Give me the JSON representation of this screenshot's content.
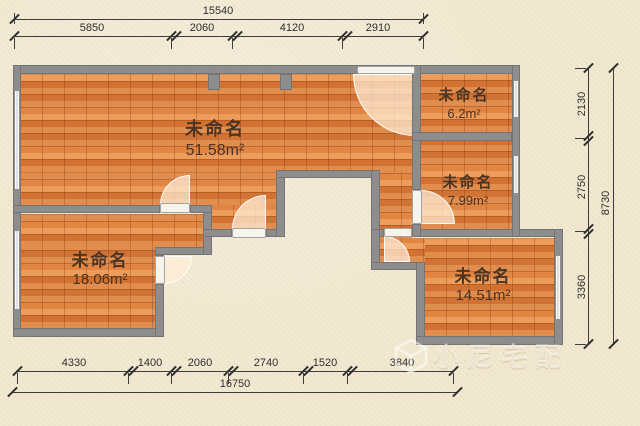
{
  "plan": {
    "rooms": [
      {
        "name": "未命名",
        "area": "51.58m²"
      },
      {
        "name": "未命名",
        "area": "6.2m²"
      },
      {
        "name": "未命名",
        "area": "7.99m²"
      },
      {
        "name": "未命名",
        "area": "18.06m²"
      },
      {
        "name": "未命名",
        "area": "14.51m²"
      }
    ]
  },
  "dims": {
    "top": {
      "total": "15540",
      "segments": [
        "5850",
        "2060",
        "4120",
        "2910"
      ]
    },
    "right": {
      "total": "8730",
      "segments": [
        "2130",
        "2750",
        "3360"
      ]
    },
    "bottom": {
      "total": "16750",
      "segments": [
        "4330",
        "1400",
        "2060",
        "2740",
        "1520",
        "3840"
      ]
    }
  },
  "watermark": {
    "text": "小尼宅配",
    "icon": "cube-logo"
  },
  "colors": {
    "floor_wood": "#dd7e3c",
    "wall": "#8d8d8d",
    "background": "#f2e8cf",
    "dimension_text": "#2f2f2f",
    "room_label": "#4a3423",
    "door_arc": "#ffeed8"
  }
}
